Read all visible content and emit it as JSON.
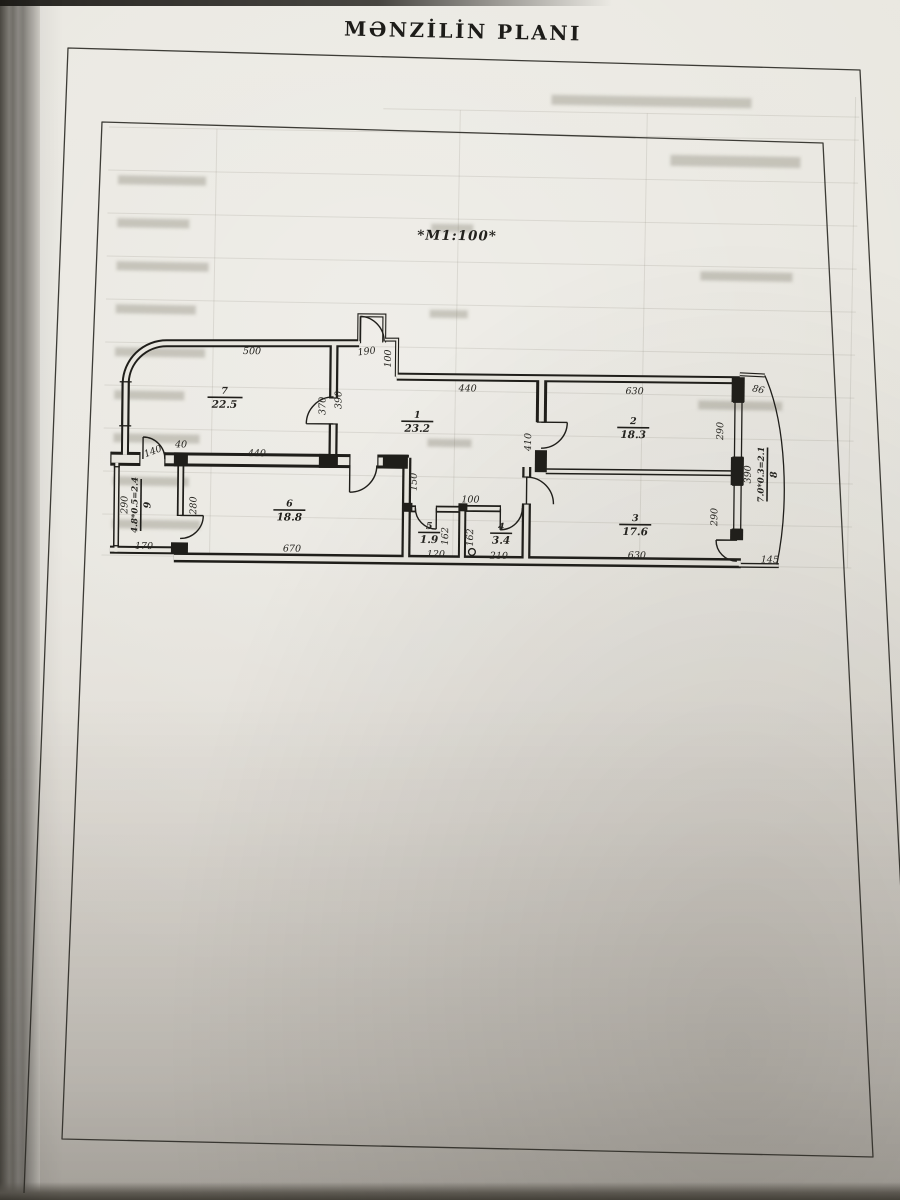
{
  "header": {
    "title": "MƏNZİLİN PLANI"
  },
  "plan": {
    "scale_note": "*M1:100*",
    "rooms": {
      "r1": {
        "number": "1",
        "area": "23.2"
      },
      "r2": {
        "number": "2",
        "area": "18.3"
      },
      "r3": {
        "number": "3",
        "area": "17.6"
      },
      "r4": {
        "number": "4",
        "area": "3.4"
      },
      "r5": {
        "number": "5",
        "area": "1.9"
      },
      "r6": {
        "number": "6",
        "area": "18.8"
      },
      "r7": {
        "number": "7",
        "area": "22.5"
      },
      "r8": {
        "number": "8",
        "formula": "7.0*0.3=2.1"
      },
      "r9": {
        "number": "9",
        "formula": "4.8*0.5=2.4"
      }
    },
    "dimensions": {
      "room7_top": "500",
      "entry_niche": "190",
      "niche_depth": "100",
      "hall_top": "440",
      "room2_top": "630",
      "balcony_top": "86",
      "room7_wall_a": "370",
      "room7_wall_b": "390",
      "room2_door_wall": "410",
      "room2_window": "290",
      "pier": "40",
      "room7_door": "140",
      "room6_top": "440",
      "room9_left": "290",
      "room9_right": "280",
      "room9_bottom": "170",
      "room6_bottom": "670",
      "corridor": "150",
      "wc_top": "100",
      "room5_height": "162",
      "room4_height": "162",
      "room5_bottom": "120",
      "room4_bottom": "210",
      "room3_bottom": "630",
      "balcony_bottom": "145",
      "balcony_side": "390",
      "room3_window": "290"
    }
  }
}
